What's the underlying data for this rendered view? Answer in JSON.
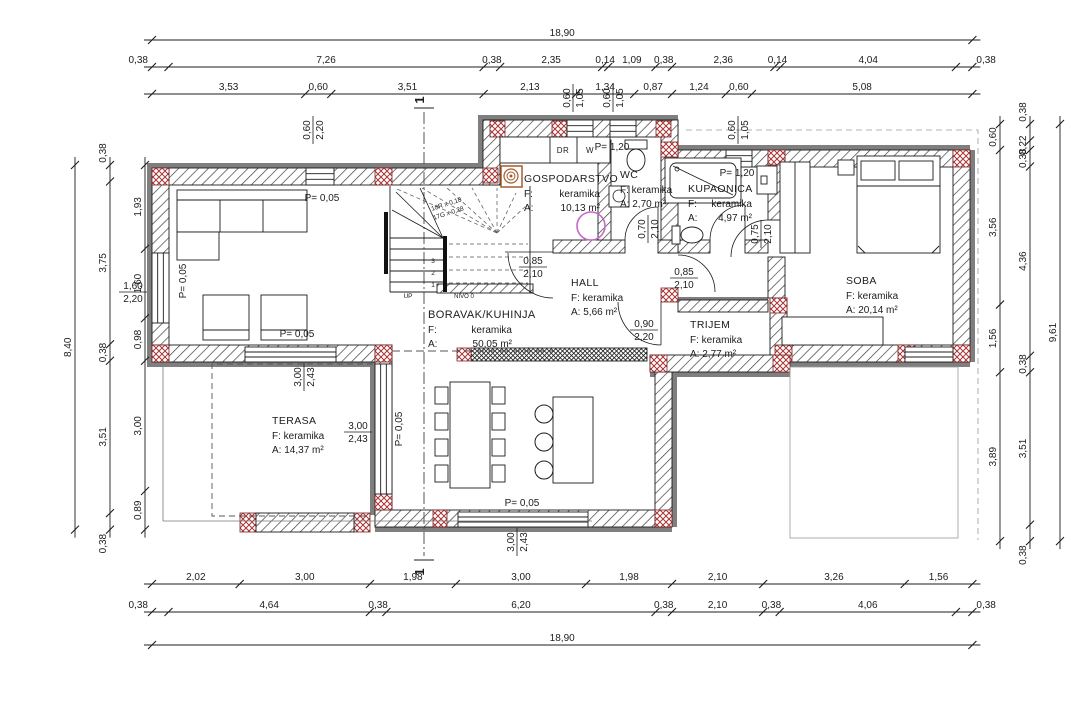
{
  "palette": {
    "line": "#1c1c1c",
    "hatch": "#3f3f3f",
    "wall_band_gray": "#7f7f7f",
    "pier_red": "#a83434",
    "boiler_magenta": "#c767c7",
    "chimney_brown": "#a55a2a",
    "faint": "#999999"
  },
  "dim_rows": [
    {
      "id": "top1",
      "labels": [
        "18,90"
      ]
    },
    {
      "id": "top2",
      "labels": [
        "0,38",
        "7,26",
        "0,38",
        "2,35",
        "0,14",
        "1,09",
        "0,38",
        "2,36",
        "0,14",
        "4,04",
        "0,38"
      ]
    },
    {
      "id": "top3",
      "labels": [
        "3,53",
        "0,60",
        "3,51",
        "2,13",
        "1,34",
        "0,87",
        "1,24",
        "0,60",
        "5,08"
      ]
    },
    {
      "id": "bottom1",
      "labels": [
        "2,02",
        "3,00",
        "1,98",
        "3,00",
        "1,98",
        "2,10",
        "3,26",
        "1,56"
      ]
    },
    {
      "id": "bottom2",
      "labels": [
        "0,38",
        "4,64",
        "0,38",
        "6,20",
        "0,38",
        "2,10",
        "0,38",
        "4,06",
        "0,38"
      ]
    },
    {
      "id": "bottom3",
      "labels": [
        "18,90"
      ]
    },
    {
      "id": "left1",
      "labels": [
        "8,40"
      ]
    },
    {
      "id": "left2",
      "labels": [
        "0,38",
        "3,75",
        "0,38",
        "3,51",
        "0,38"
      ]
    },
    {
      "id": "left3",
      "labels": [
        "1,93",
        "1,60",
        "0,98",
        "3,00",
        "0,89"
      ]
    },
    {
      "id": "right1",
      "labels": [
        "0,60",
        "3,56",
        "1,56",
        "3,89"
      ]
    },
    {
      "id": "right2",
      "labels": [
        "0,38",
        "0,22",
        "0,38",
        "4,36",
        "0,38",
        "3,51",
        "0,38"
      ]
    },
    {
      "id": "right3",
      "labels": [
        "9,61"
      ]
    }
  ],
  "rooms": [
    {
      "id": "gospodarstvo",
      "name": "GOSPODARSTVO",
      "floor_key": "F:",
      "floor": "keramika",
      "area_key": "A:",
      "area": "10,13 m²"
    },
    {
      "id": "wc",
      "name": "WC",
      "floor_key": "F:",
      "floor": "keramika",
      "area_key": "A:",
      "area": "2,70 m²"
    },
    {
      "id": "kupaonica",
      "name": "KUPAONICA",
      "floor_key": "F:",
      "floor": "keramika",
      "area_key": "A:",
      "area": "4,97 m²"
    },
    {
      "id": "soba",
      "name": "SOBA",
      "floor_key": "F:",
      "floor": "keramika",
      "area_key": "A:",
      "area": "20,14 m²"
    },
    {
      "id": "hall",
      "name": "HALL",
      "floor_key": "F:",
      "floor": "keramika",
      "area_key": "A:",
      "area": "5,66 m²"
    },
    {
      "id": "boravak",
      "name": "BORAVAK/KUHINJA",
      "floor_key": "F:",
      "floor": "keramika",
      "area_key": "A:",
      "area": "50,05 m²"
    },
    {
      "id": "terasa",
      "name": "TERASA",
      "floor_key": "F:",
      "floor": "keramika",
      "area_key": "A:",
      "area": "14,37 m²"
    },
    {
      "id": "trijem",
      "name": "TRIJEM",
      "floor_key": "F:",
      "floor": "keramika",
      "area_key": "A:",
      "area": "2,77 m²"
    }
  ],
  "openings": [
    {
      "w": "0,60",
      "h": "2,20"
    },
    {
      "w": "0,60",
      "h": "1,05"
    },
    {
      "w": "0,60",
      "h": "1,05"
    },
    {
      "w": "0,60",
      "h": "1,05"
    },
    {
      "w": "1,60",
      "h": "2,20"
    },
    {
      "w": "0,85",
      "h": "2,10"
    },
    {
      "w": "0,70",
      "h": "2,10"
    },
    {
      "w": "0,75",
      "h": "2,10"
    },
    {
      "w": "0,85",
      "h": "2,10"
    },
    {
      "w": "0,90",
      "h": "2,20"
    },
    {
      "w": "3,00",
      "h": "2,43"
    },
    {
      "w": "3,00",
      "h": "2,43"
    },
    {
      "w": "3,00",
      "h": "2,43"
    }
  ],
  "surface_labels": [
    {
      "text": "P= 0,05"
    },
    {
      "text": "P= 0,05"
    },
    {
      "text": "P= 0,05"
    },
    {
      "text": "P= 0,05"
    },
    {
      "text": "P= 0,05"
    },
    {
      "text": "P= 1,20"
    },
    {
      "text": "P= 1,20"
    }
  ],
  "stair": {
    "risers": "18R x 0,18",
    "goings": "17G x 0,28",
    "direction": "UP",
    "level": "NIVO 0",
    "step_numbers": [
      "1",
      "2",
      "3"
    ]
  },
  "appliances": [
    {
      "label": "DR"
    },
    {
      "label": "W"
    }
  ],
  "section_marks": [
    {
      "label": "1"
    },
    {
      "label": "1"
    }
  ]
}
